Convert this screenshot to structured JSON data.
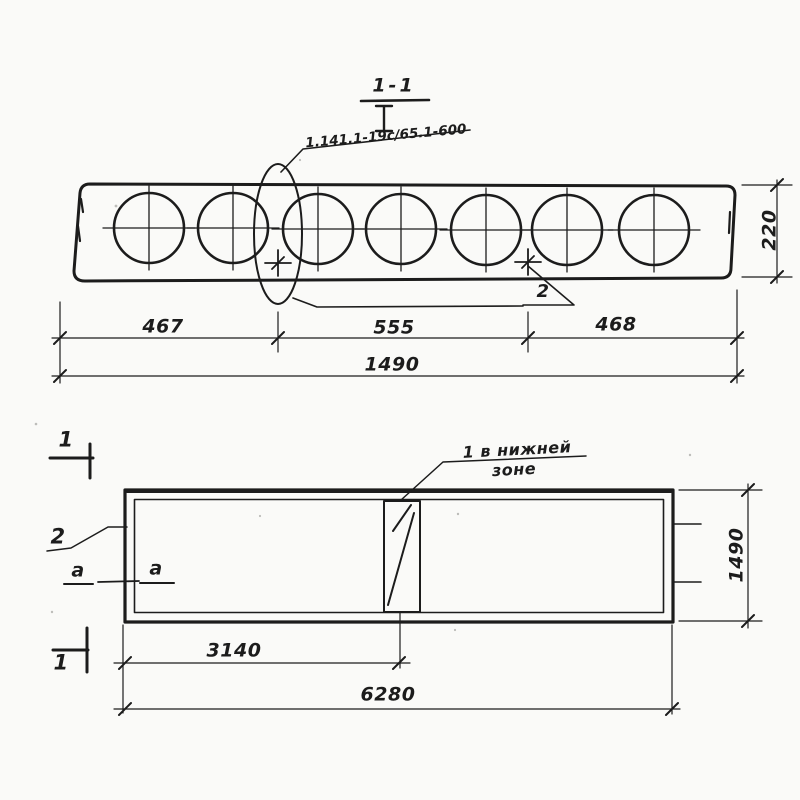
{
  "colors": {
    "ink": "#1c1c1c",
    "paper": "#fafaf8"
  },
  "section_view": {
    "title": "1-1",
    "series_label": "1.141.1-19с/65.1-600",
    "item_marker_label": "2",
    "dim_left": "467",
    "dim_middle": "555",
    "dim_right": "468",
    "dim_total": "1490",
    "dim_height": "220"
  },
  "plan_view": {
    "cut_mark_top_label": "1",
    "cut_mark_bottom_label": "1",
    "edge_item_label": "2",
    "axis_label_outer": "a",
    "axis_label_inner": "a",
    "rebar_note_line1": "1 в нижней",
    "rebar_note_line2": "зоне",
    "dim_to_rebar": "3140",
    "dim_length": "6280",
    "dim_width": "1490"
  }
}
